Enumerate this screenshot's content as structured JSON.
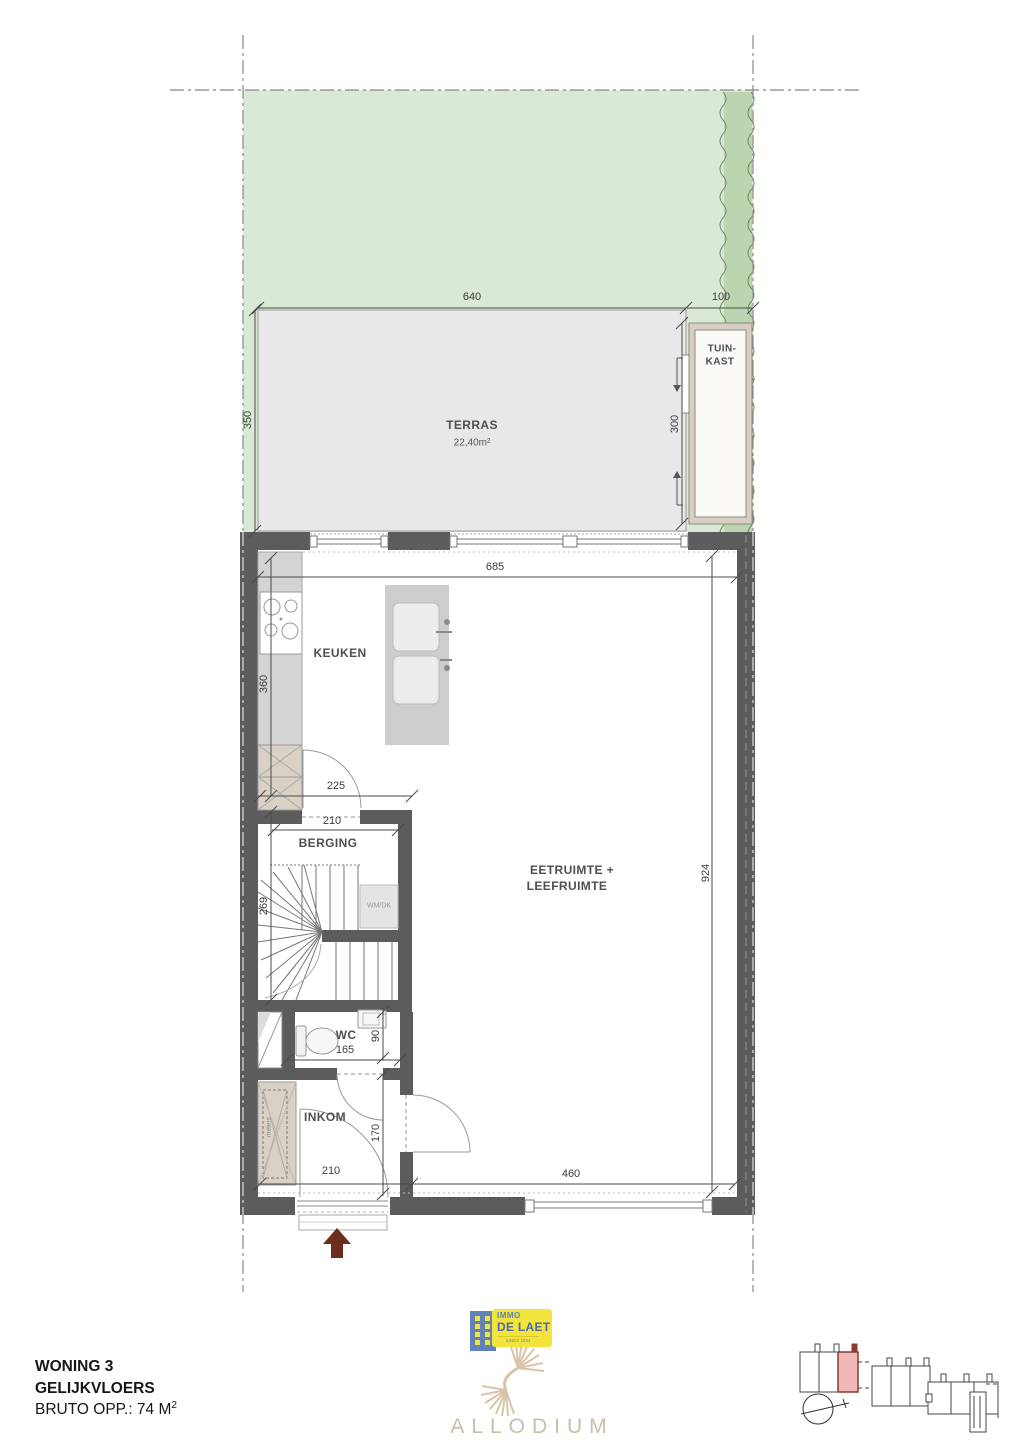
{
  "plan": {
    "rooms": {
      "terras": "TERRAS",
      "terras_area": "22,40m²",
      "tuinkast_line1": "TUIN-",
      "tuinkast_line2": "KAST",
      "keuken": "KEUKEN",
      "berging": "BERGING",
      "living_line1": "EETRUIMTE +",
      "living_line2": "LEEFRUIMTE",
      "wc": "WC",
      "inkom": "INKOM",
      "wmdk": "WM/DK",
      "meters": "meters"
    },
    "dims": {
      "terras_w": "640",
      "strip": "100",
      "terras_d": "350",
      "gate": "300",
      "interior_w": "685",
      "keuken_d": "360",
      "keuken_open": "225",
      "berging_w": "210",
      "berging_d": "269",
      "living_d": "924",
      "wc_w": "165",
      "wc_d": "90",
      "inkom_d": "170",
      "inkom_w": "210",
      "window_w": "460"
    }
  },
  "title": {
    "line1": "WONING 3",
    "line2": "GELIJKVLOERS",
    "line3": "BRUTO OPP.: 74 M",
    "line3_sup": "2"
  },
  "branding": {
    "immo_top": "IMMO",
    "immo_name": "DE LAET",
    "immo_tagline": "SINDS 1894",
    "partner": "ALLODIUM"
  },
  "colors": {
    "wall": "#5c5c5c",
    "garden": "#d9e9d5",
    "hedge": "#bcd5b0",
    "terrace": "#e8e8e8",
    "cabinet_tan": "#d9d1c5",
    "counter": "#d4d4d4",
    "highlight_unit": "#f0b9b7",
    "entry_arrow": "#6b2e1d",
    "logo_yellow": "#f2e43c",
    "logo_blue": "#5d80b8",
    "allodium_taupe": "#c9beac"
  }
}
